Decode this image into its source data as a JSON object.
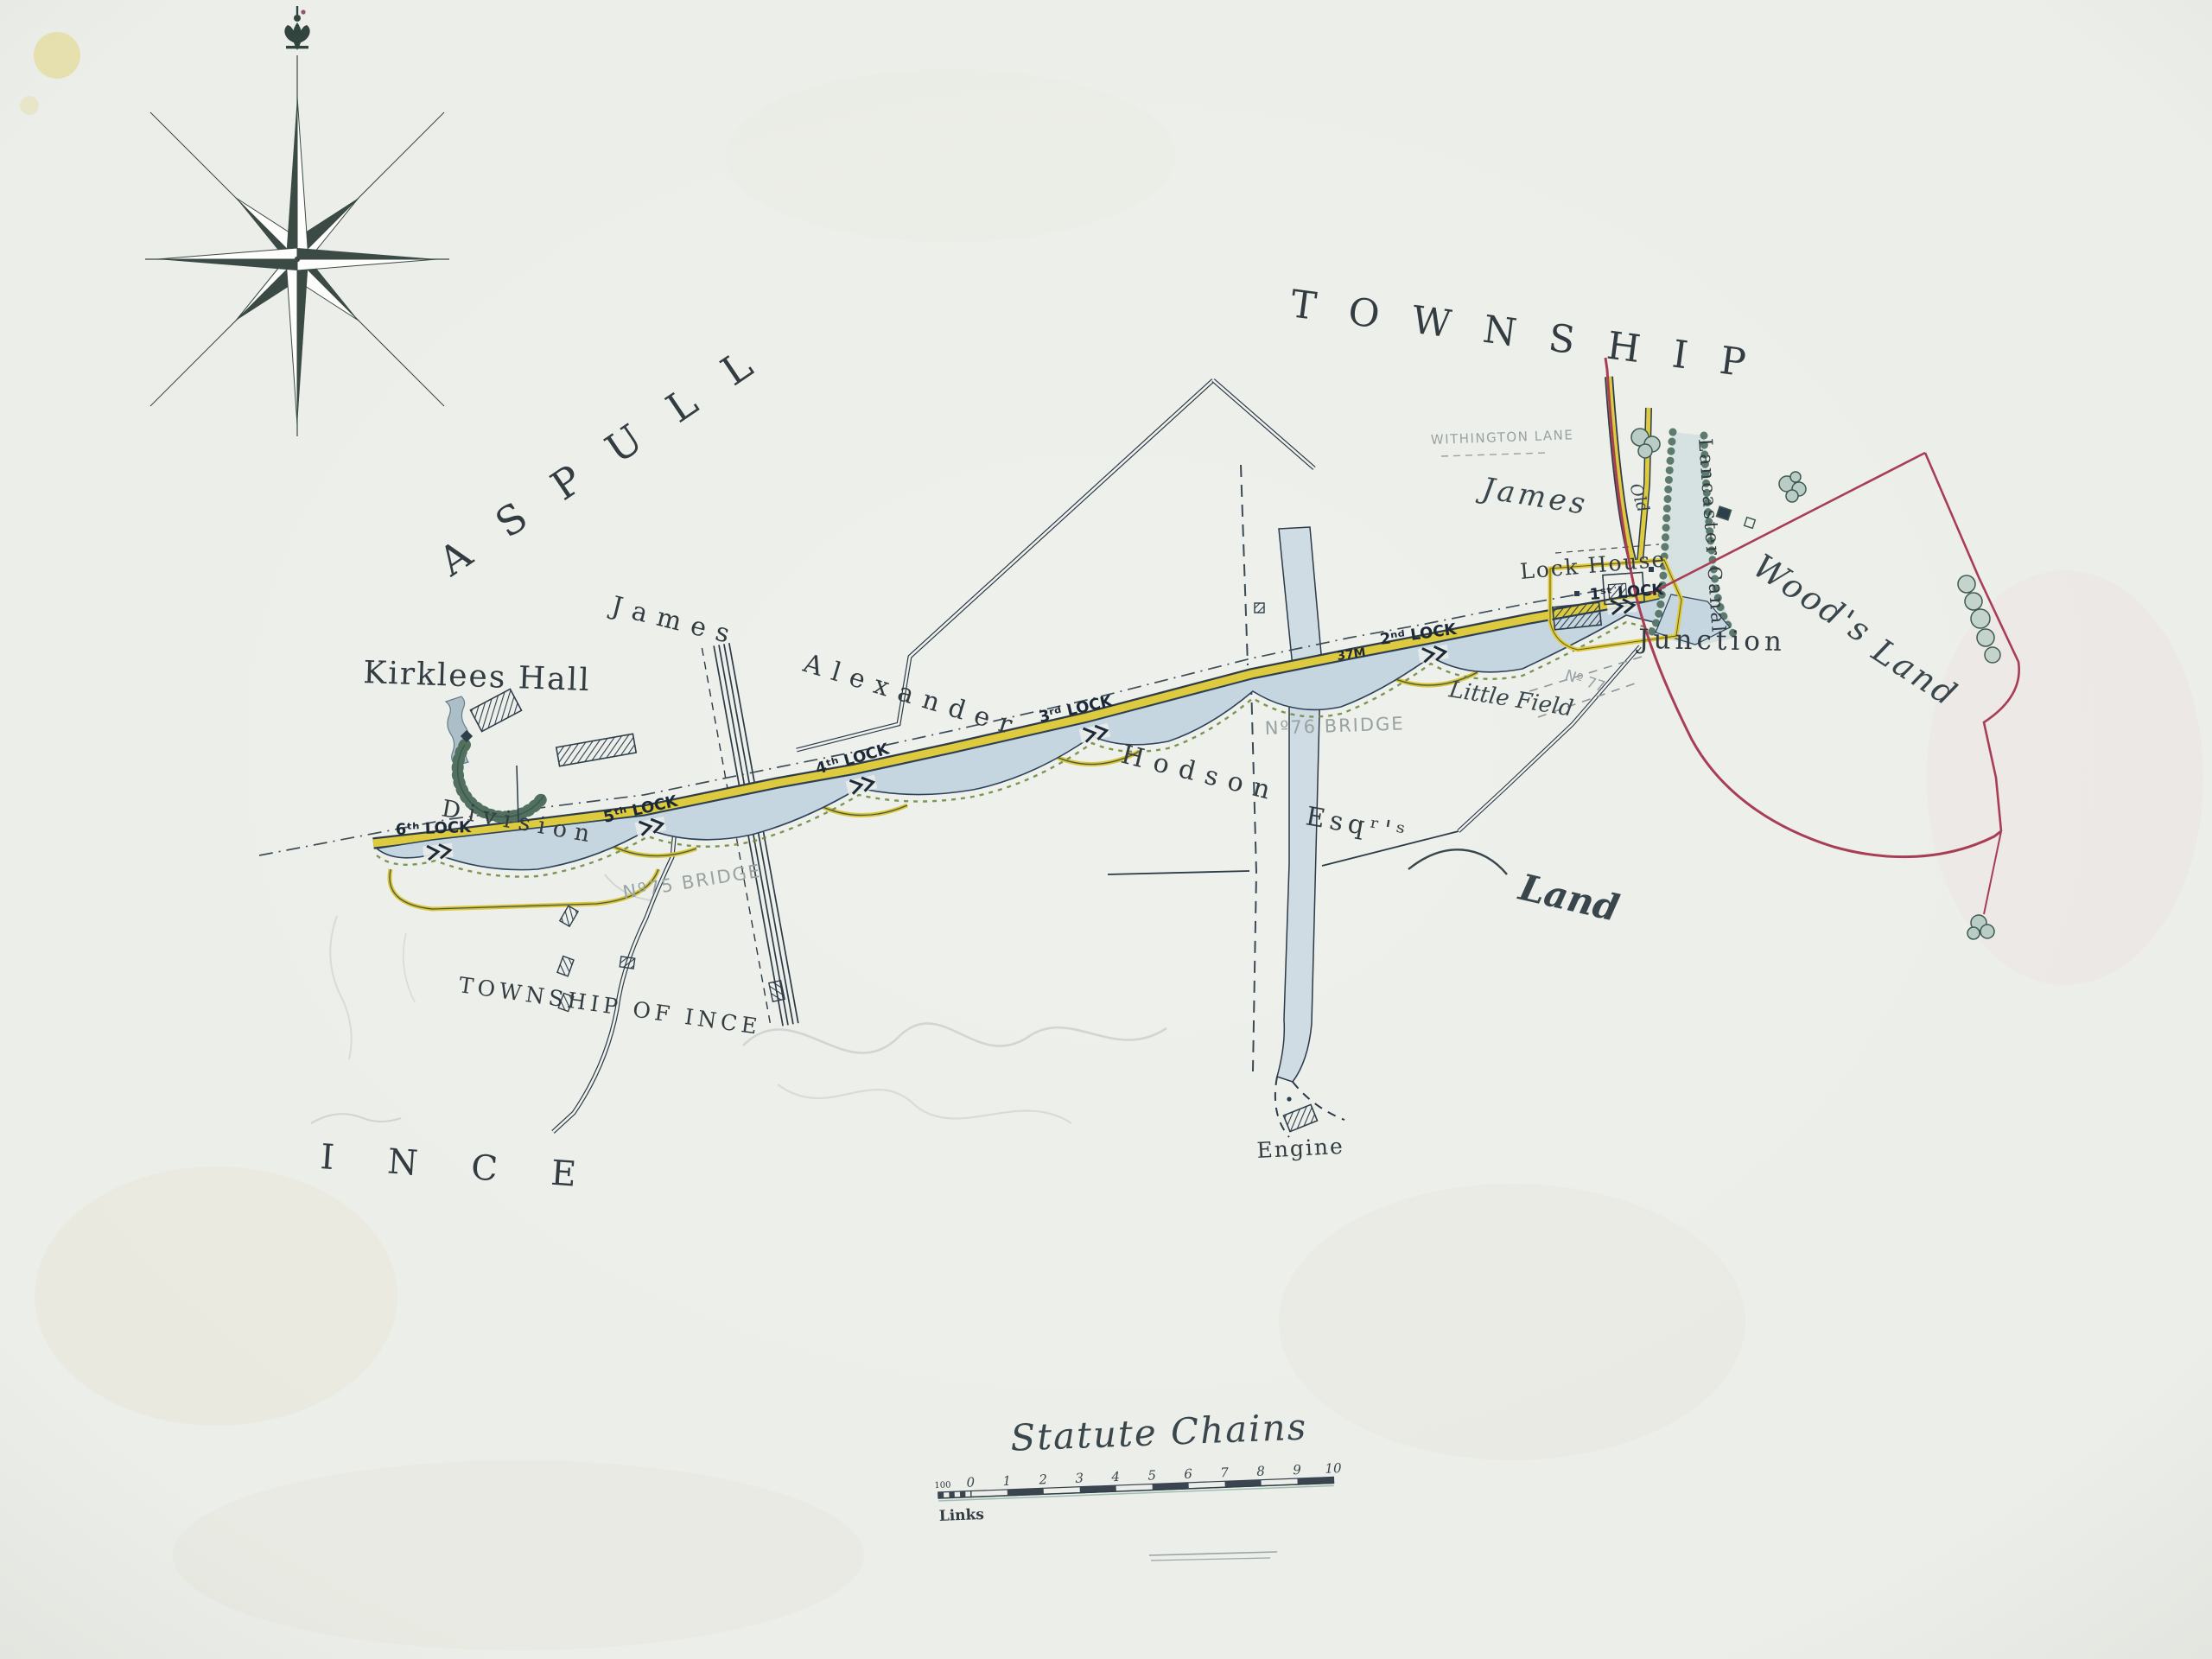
{
  "map": {
    "region_labels": {
      "township": "TOWNSHIP",
      "aspull": "ASPULL",
      "ince": "INCE",
      "township_of_ince": "TOWNSHIP  OF  INCE"
    },
    "estate_labels": {
      "james_w": "James",
      "alexander": "Alexander",
      "hodson": "Hodson",
      "esqrs": "Esqʳ'ˢ",
      "land_sw": "Land",
      "james_e": "James",
      "woods": "Wood's",
      "land_e": "Land",
      "little_field": "Little Field"
    },
    "place_labels": {
      "kirklees_hall": "Kirklees Hall",
      "division": "Division",
      "lock_house": "Lock House",
      "junction": "Junction",
      "lancaster_canal": "Lancaster Canal",
      "old_road": "Old",
      "engine": "Engine"
    },
    "locks": {
      "l6": "6ᵗʰ LOCK",
      "l5": "5ᵗʰ LOCK",
      "l4": "4ᵗʰ LOCK",
      "l3": "3ʳᵈ LOCK",
      "l2": "2ⁿᵈ LOCK",
      "l1": "1ˢᵗ LOCK",
      "milestone": "37M"
    },
    "bridges": {
      "b75": "Nº75 BRIDGE",
      "b76": "Nº76 BRIDGE"
    },
    "pencil_notes": {
      "withington_lane": "WITHINGTON LANE",
      "no77": "Nº 77"
    },
    "scale": {
      "title": "Statute Chains",
      "links": "Links",
      "hundred": "100",
      "ticks": [
        "0",
        "1",
        "2",
        "3",
        "4",
        "5",
        "6",
        "7",
        "8",
        "9",
        "10"
      ]
    },
    "colors": {
      "paper": "#eef0ec",
      "ink": "#2c3a47",
      "water": "#c6d6e0",
      "towpath_yellow": "#ddca3e",
      "hedge_green": "#6e8c42",
      "boundary_red": "#a83d56",
      "pencil_grey": "#98a2a3",
      "tree_green": "#4f6e60"
    }
  }
}
